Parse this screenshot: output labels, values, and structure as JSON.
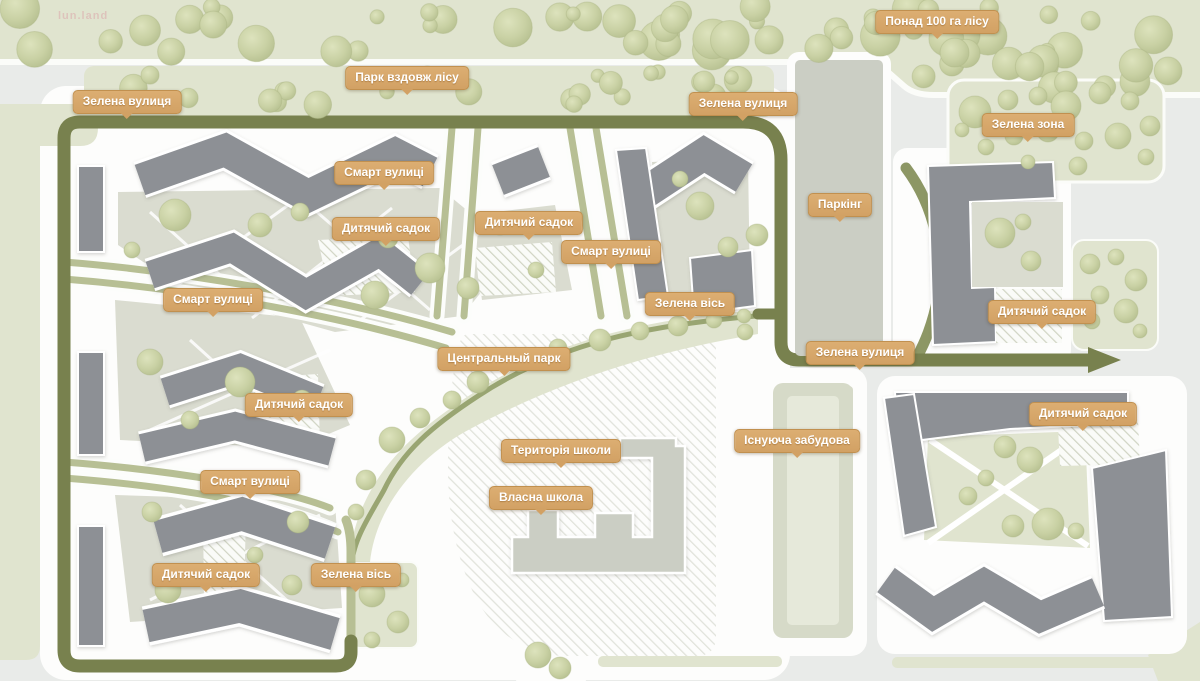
{
  "watermark": {
    "text": "lun.land"
  },
  "map": {
    "labels": [
      {
        "id": "forest-area",
        "text": "Понад 100 га лісу",
        "x": 937,
        "y": 10
      },
      {
        "id": "park-along-forest",
        "text": "Парк вздовж лісу",
        "x": 407,
        "y": 66
      },
      {
        "id": "green-street-nw",
        "text": "Зелена вулиця",
        "x": 127,
        "y": 90
      },
      {
        "id": "green-street-ne",
        "text": "Зелена вулиця",
        "x": 743,
        "y": 92
      },
      {
        "id": "green-zone",
        "text": "Зелена зона",
        "x": 1028,
        "y": 113
      },
      {
        "id": "smart-streets-n",
        "text": "Смарт вулиці",
        "x": 384,
        "y": 161
      },
      {
        "id": "kindergarten-nw",
        "text": "Дитячий садок",
        "x": 386,
        "y": 217
      },
      {
        "id": "kindergarten-n",
        "text": "Дитячий садок",
        "x": 529,
        "y": 211
      },
      {
        "id": "smart-streets-ne",
        "text": "Смарт вулиці",
        "x": 611,
        "y": 240
      },
      {
        "id": "parking",
        "text": "Паркінг",
        "x": 840,
        "y": 193
      },
      {
        "id": "smart-streets-w",
        "text": "Смарт вулиці",
        "x": 213,
        "y": 288
      },
      {
        "id": "green-axis-e",
        "text": "Зелена вісь",
        "x": 690,
        "y": 292
      },
      {
        "id": "kindergarten-e1",
        "text": "Дитячий садок",
        "x": 1042,
        "y": 300
      },
      {
        "id": "green-street-se",
        "text": "Зелена вулиця",
        "x": 860,
        "y": 341
      },
      {
        "id": "central-park",
        "text": "Центральный парк",
        "x": 504,
        "y": 347
      },
      {
        "id": "kindergarten-w",
        "text": "Дитячий садок",
        "x": 299,
        "y": 393
      },
      {
        "id": "kindergarten-e2",
        "text": "Дитячий садок",
        "x": 1083,
        "y": 402
      },
      {
        "id": "existing-buildings",
        "text": "Існуюча забудова",
        "x": 797,
        "y": 429
      },
      {
        "id": "school-territory",
        "text": "Територія школи",
        "x": 561,
        "y": 439
      },
      {
        "id": "smart-streets-sw",
        "text": "Смарт вулиці",
        "x": 250,
        "y": 470
      },
      {
        "id": "own-school",
        "text": "Власна школа",
        "x": 541,
        "y": 486
      },
      {
        "id": "kindergarten-s",
        "text": "Дитячий садок",
        "x": 206,
        "y": 563
      },
      {
        "id": "green-axis-s",
        "text": "Зелена вісь",
        "x": 356,
        "y": 563
      }
    ]
  },
  "colors": {
    "background": "#e9ebe9",
    "built_area": "#fdfdfc",
    "greenery": "#e0e4cf",
    "tree": "#c8cfa3",
    "main_road": "#78814e",
    "secondary_road": "#8d9765",
    "smart_street": "#b7bf94",
    "green_axis": "#99a572",
    "building": "#8d9095",
    "service_building": "#cbcec4",
    "existing_building": "#d6dac8",
    "existing_building_inner": "#e6e9da",
    "courtyard": "#dadcd0",
    "label_bg": "#d2a164",
    "label_text": "#ffffff"
  }
}
